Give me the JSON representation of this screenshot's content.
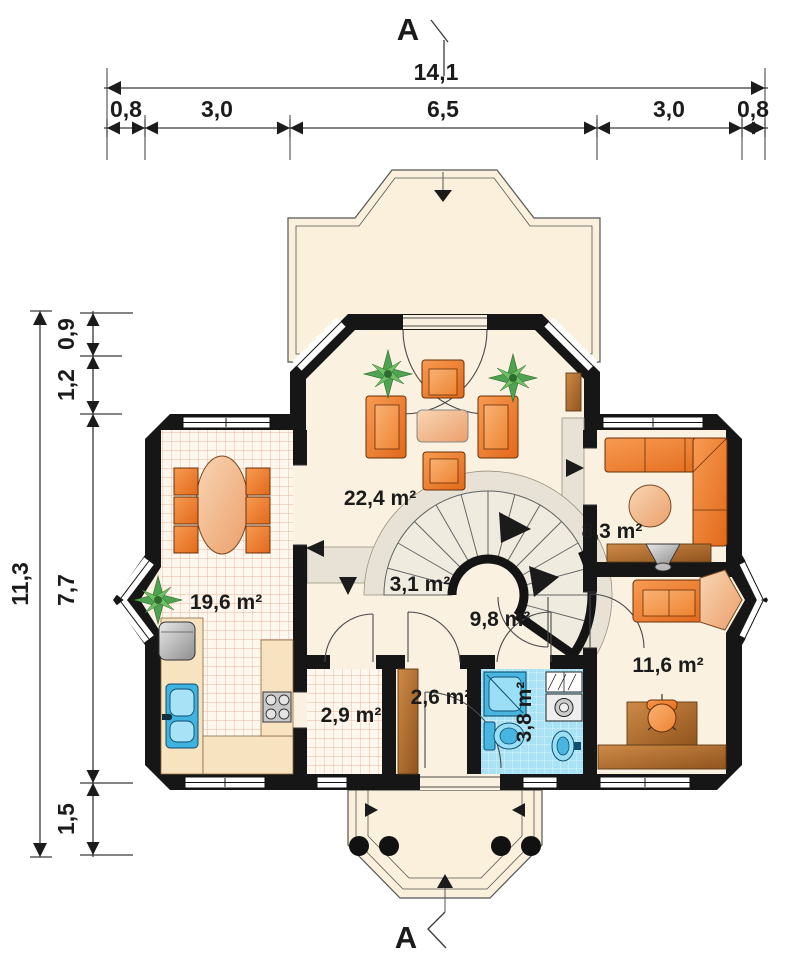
{
  "section_marks": {
    "top": "A",
    "bottom": "A"
  },
  "dimensions": {
    "horizontal": {
      "overall": "14,1",
      "segments": [
        "0,8",
        "3,0",
        "6,5",
        "3,0",
        "0,8"
      ]
    },
    "vertical": {
      "overall": "11,3",
      "segments": [
        "0,9",
        "1,2",
        "7,7",
        "1,5"
      ]
    }
  },
  "rooms": {
    "living_room": {
      "area_label": "22,4 m²"
    },
    "kitchen_dining": {
      "area_label": "19,6 m²"
    },
    "staircase": {
      "area_label": "3,1 m²"
    },
    "hall": {
      "area_label": "9,8 m²"
    },
    "sitting_room": {
      "area_label": "8,3 m²"
    },
    "office": {
      "area_label": "11,6 m²"
    },
    "pantry": {
      "area_label": "2,9 m²"
    },
    "wardrobe": {
      "area_label": "2,6 m²"
    },
    "bathroom": {
      "area_label": "3,8 m²"
    }
  },
  "colors": {
    "wall": "#161616",
    "floor": "#FAF1E1",
    "terrace": "#FAF0DC",
    "walkway": "#E7E2D5",
    "stair_tread": "#EFEBDF",
    "tile_pink_bg": "#FDF7EE",
    "tile_pink_line": "#EAB49B",
    "tile_blue_bg": "#A9E2F5",
    "furniture_orange": "#EE7F2D",
    "wood": "#C0803E",
    "fixture_blue": "#4FB9E2"
  }
}
